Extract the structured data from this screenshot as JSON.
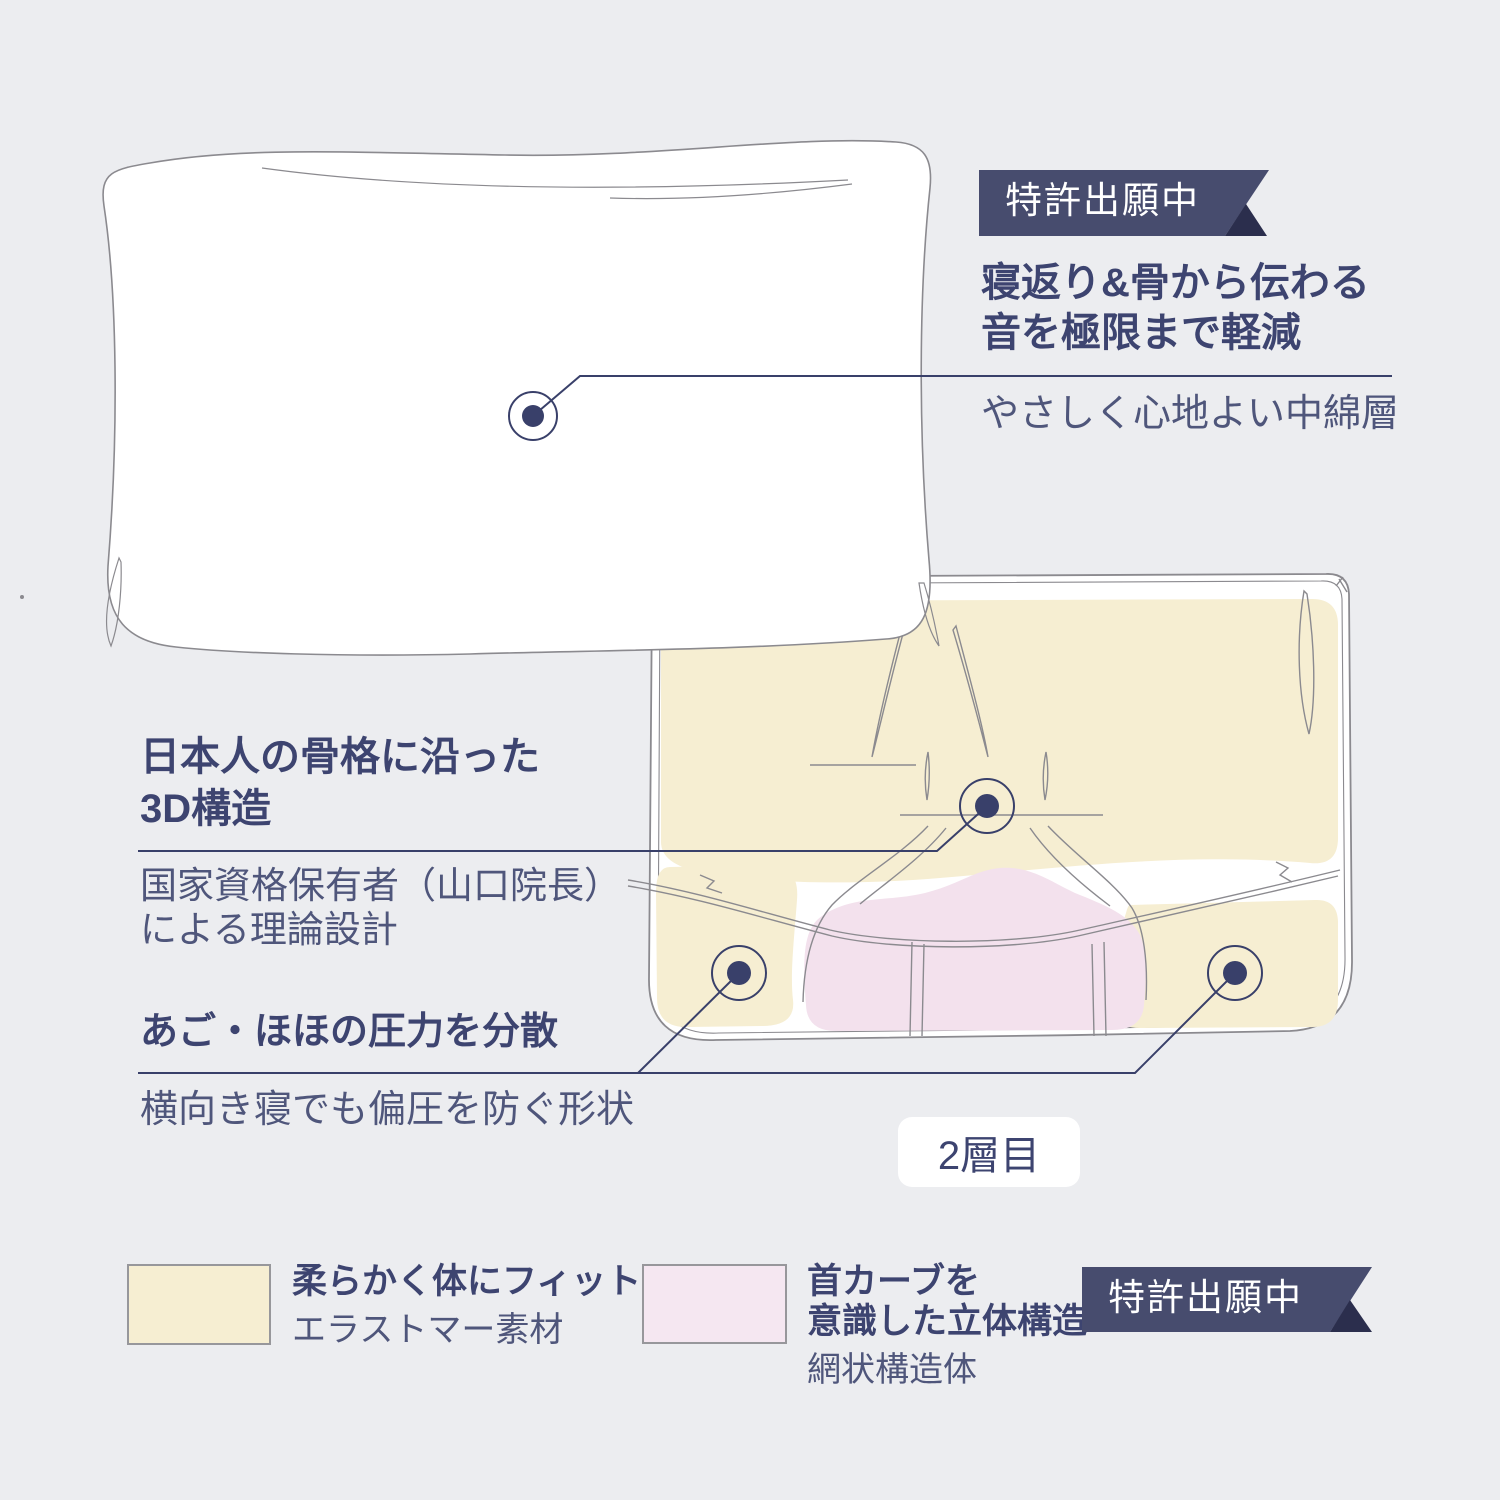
{
  "colors": {
    "bg": "#ECEDF0",
    "navy": "#3D4470",
    "body": "#4F567B",
    "marker": "#39406A",
    "sketch": "#8B8A8F",
    "ribbon": "#474C6E",
    "ribbon_fold": "#2B2E4D",
    "cream": "#F6EED2",
    "pink": "#F3E1ED",
    "swatch_pink": "#F5E7F1",
    "white": "#FFFFFF"
  },
  "badges": {
    "top": {
      "label": "特許出願中"
    },
    "bottom": {
      "label": "特許出願中"
    }
  },
  "callouts": {
    "cotton": {
      "title_line1": "寝返り&骨から伝わる",
      "title_line2": "音を極限まで軽減",
      "description": "やさしく心地よい中綿層"
    },
    "structure_3d": {
      "title_line1": "日本人の骨格に沿った",
      "title_line2": "3D構造",
      "description_line1": "国家資格保有者（山口院長）",
      "description_line2": "による理論設計"
    },
    "pressure": {
      "title": "あご・ほほの圧力を分散",
      "description": "横向き寝でも偏圧を防ぐ形状"
    }
  },
  "layer_label": "2層目",
  "legend": {
    "elastomer": {
      "title": "柔らかく体にフィット",
      "material": "エラストマー素材",
      "swatch_color": "#F6EED2"
    },
    "mesh": {
      "title_line1": "首カーブを",
      "title_line2": "意識した立体構造",
      "material": "網状構造体",
      "swatch_color": "#F5E7F1"
    }
  }
}
